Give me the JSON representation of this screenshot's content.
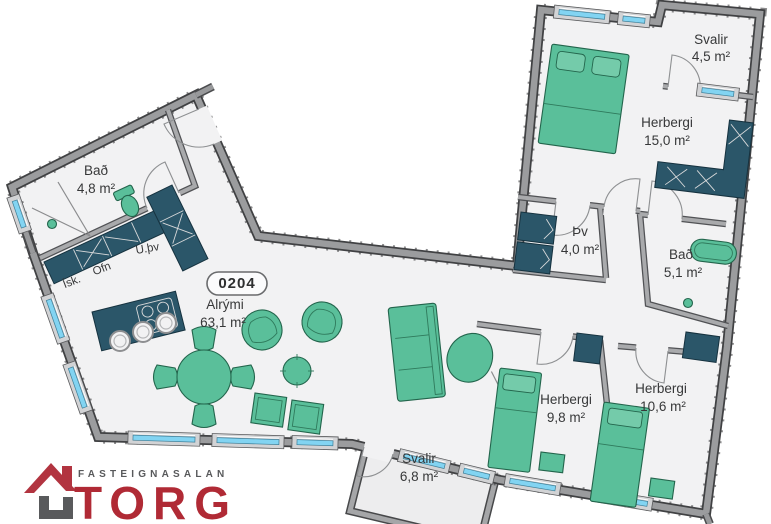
{
  "unit": {
    "badge": "0204"
  },
  "rooms": {
    "alrymi": {
      "name": "Alrými",
      "area": "63,1 m²"
    },
    "bad_small": {
      "name": "Bað",
      "area": "4,8 m²"
    },
    "svalir_top": {
      "name": "Svalir",
      "area": "4,5 m²"
    },
    "herbergi_15": {
      "name": "Herbergi",
      "area": "15,0 m²"
    },
    "thv": {
      "name": "Þv",
      "area": "4,0 m²"
    },
    "bad_51": {
      "name": "Bað",
      "area": "5,1 m²"
    },
    "herbergi_98": {
      "name": "Herbergi",
      "area": "9,8 m²"
    },
    "herbergi_106": {
      "name": "Herbergi",
      "area": "10,6 m²"
    },
    "svalir_bottom": {
      "name": "Svalir",
      "area": "6,8 m²"
    }
  },
  "kitchen": {
    "ofn": "Ofn",
    "isk": "Ísk.",
    "uthv": "U.þv"
  },
  "logo": {
    "tagline": "FASTEIGNASALAN",
    "brand": "TORG"
  },
  "colors": {
    "furniture_green": "#5abf9a",
    "cabinet_teal": "#2b5669",
    "wall_gray": "#9b9c9e",
    "wall_edge": "#404143",
    "window_glass": "#82d4f2",
    "floor": "#f2f2f3",
    "logo_red": "#b02a35",
    "logo_gray": "#58595b"
  }
}
